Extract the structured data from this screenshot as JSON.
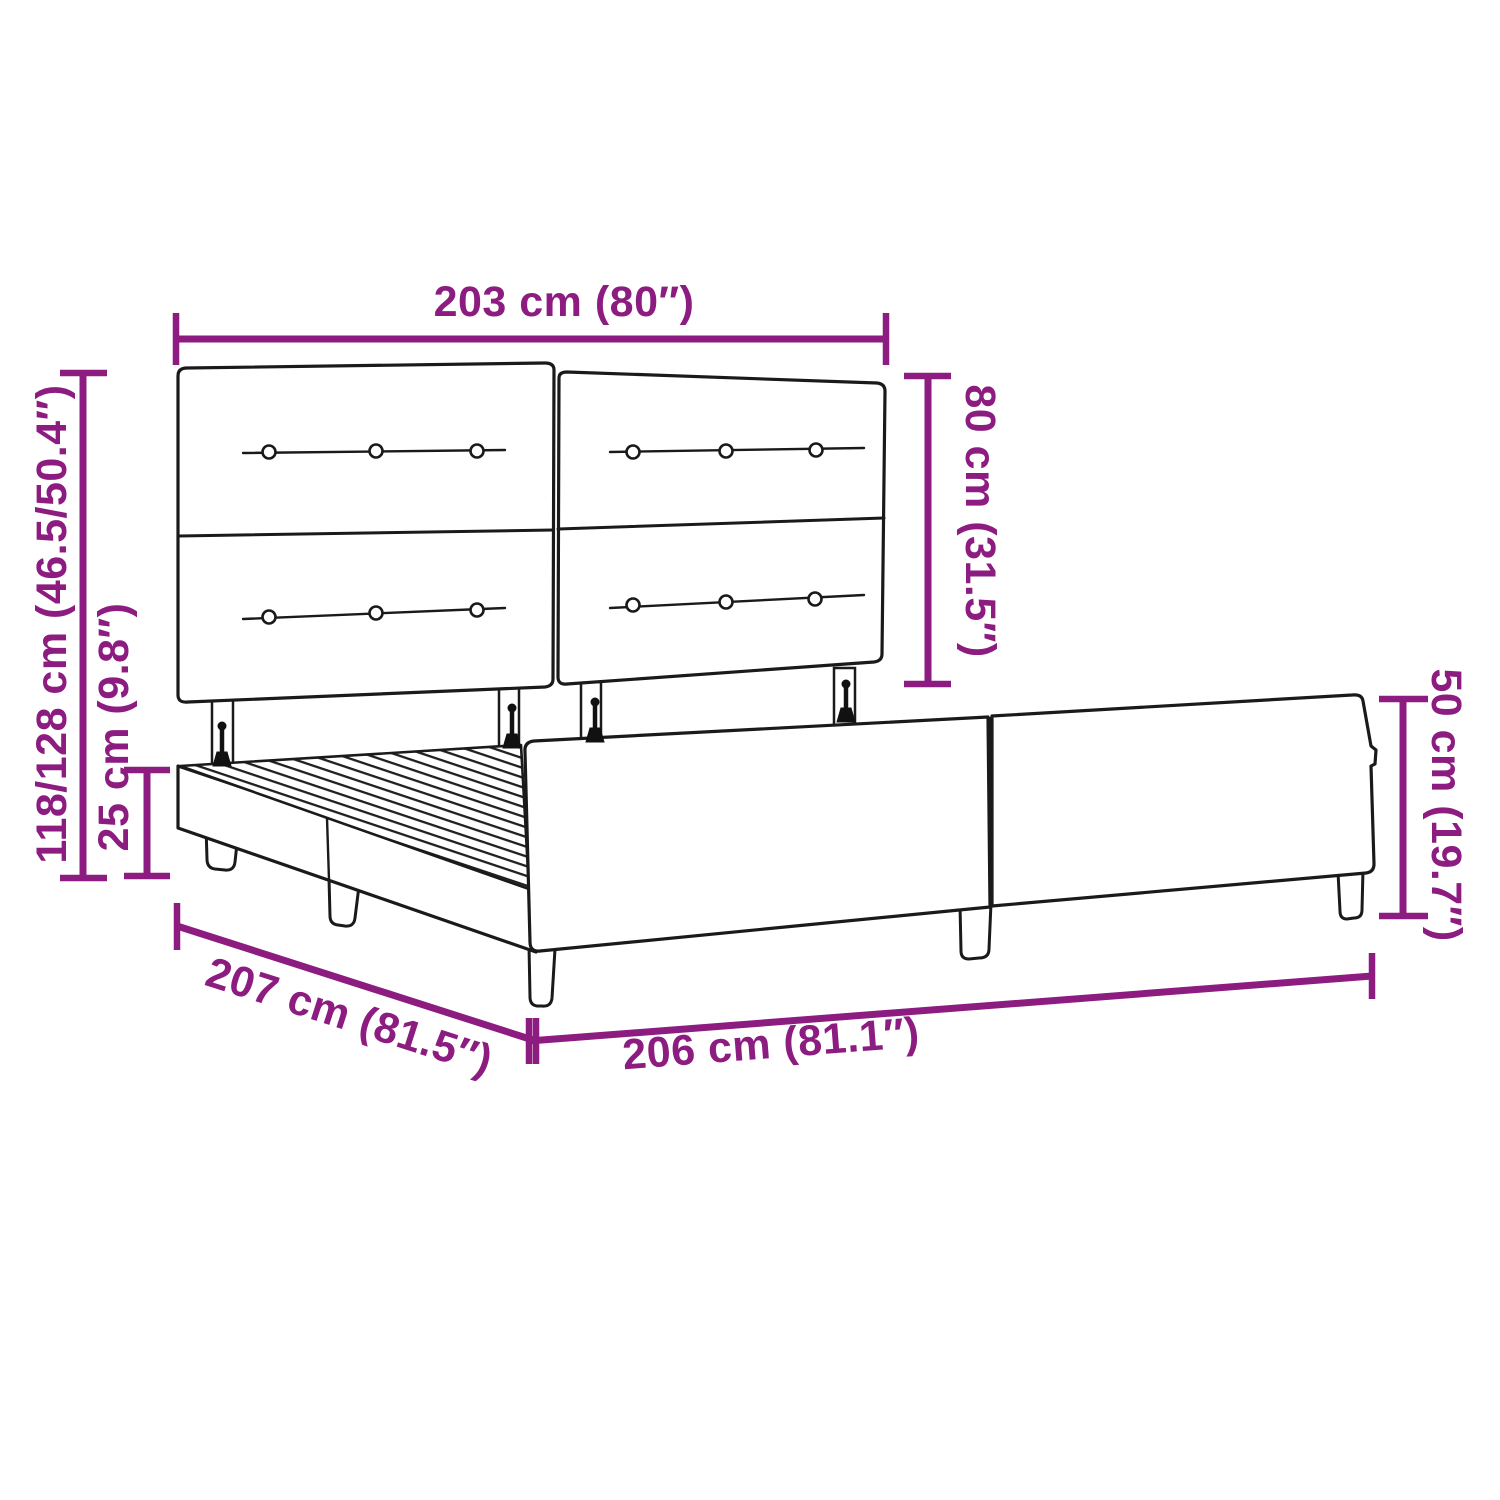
{
  "figure": {
    "title": "Bed frame dimension diagram",
    "product": "Upholstered bed frame with tufted headboard and slatted base",
    "style": {
      "accent_color": "#8C1C80",
      "line_color": "#1a1a1a",
      "background_color": "#ffffff"
    }
  },
  "dimensions": [
    {
      "id": "headboard-width",
      "label": "203 cm (80″)",
      "value_cm": "203",
      "value_in": "80"
    },
    {
      "id": "headboard-height",
      "label": "80 cm (31.5″)",
      "value_cm": "80",
      "value_in": "31.5"
    },
    {
      "id": "overall-height",
      "label": "118/128 cm (46.5/50.4″)",
      "value_cm": "118/128",
      "value_in": "46.5/50.4"
    },
    {
      "id": "base-height",
      "label": "25 cm (9.8″)",
      "value_cm": "25",
      "value_in": "9.8"
    },
    {
      "id": "side-rail-height",
      "label": "50 cm (19.7″)",
      "value_cm": "50",
      "value_in": "19.7"
    },
    {
      "id": "frame-width",
      "label": "207 cm (81.5″)",
      "value_cm": "207",
      "value_in": "81.5"
    },
    {
      "id": "frame-length",
      "label": "206 cm (81.1″)",
      "value_cm": "206",
      "value_in": "81.1"
    }
  ]
}
